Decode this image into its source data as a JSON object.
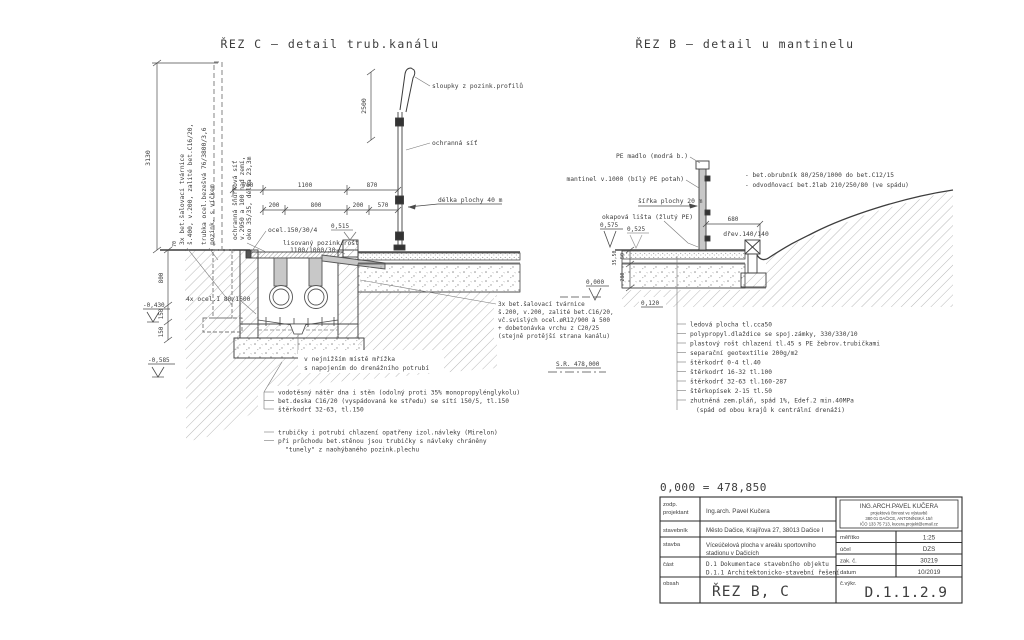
{
  "c": {
    "title": "ŘEZ C  –  detail trub.kanálu",
    "rot1a": "3x bet.šalovací tvárnice",
    "rot1b": "š.400, v.200, zalité bet.C16/20,",
    "rot2a": "trubka ocel.bezešvá 76/3800/3,6",
    "rot2b": "pozink. s víčkem",
    "rot3a": "ochranná šňůrková síť",
    "rot3b": "v.2950 a 100 nad zemí,",
    "rot3c": "oko 35/35, délka 23,3m",
    "sloupky": "sloupky z pozink.profilů",
    "ochranna_sit": "ochranná síť",
    "delka": "délka plochy 40 m",
    "ocel150": "ocel.150/30/4",
    "rost1": "lisovaný pozink.rošt",
    "rost2": "1100/1000/30",
    "elev515": "0,515",
    "ocel4x": "4x ocel.I 80/1600",
    "tv1": "3x bet.šalovací tvárnice",
    "tv2": "š.200, v.200, zalité bet.C16/20,",
    "tv3": "vč.svislých ocel.øR12/900 à 500",
    "tv4": "+ dobetonávka vrchu z C20/25",
    "tv5": "(stejně protější strana kanálu)",
    "mrizka1": "v nejnižším místě mřížka",
    "mrizka2": "s napojením do drenážního potrubí",
    "elev430": "-0,430",
    "elev585": "-0,585",
    "dim3130": "3130",
    "dim2500": "2500",
    "dim700": "700",
    "dim1100": "1100",
    "dim870": "870",
    "dim200a": "200",
    "dim800h": "800",
    "dim200b": "200",
    "dim570": "570",
    "dim70": "70",
    "dim800v": "800",
    "dim150a": "150",
    "dim150b": "150",
    "notes1": [
      "vodotěsný nátěr dna i stěn (odolný proti 35% monopropylénglykolu)",
      "bet.deska C16/20 (vyspádovaná ke středu) se sítí 150/5, tl.150",
      "štěrkodrť 32-63, tl.150"
    ],
    "notes2": [
      "trubičky i potrubí chlazení opatřeny izol.návleky (Mirelon)",
      "při průchodu bet.stěnou jsou trubičky s návleky chráněny",
      "\"tunely\" z naohýbaného pozink.plechu"
    ]
  },
  "b": {
    "title": "ŘEZ B  –  detail u mantinelu",
    "pe_madlo": "PE madlo (modrá b.)",
    "mantinel": "mantinel v.1000 (bílý PE potah)",
    "obrubnik": "-  bet.obrubník 80/250/1000 do bet.C12/15",
    "zlab": "-  odvodňovací bet.žlab 210/250/80 (ve spádu)",
    "sirka": "šířka plochy 20 m",
    "okapova": "okapová lišta (žlutý PE)",
    "elev575": "0,575",
    "elev525": "0,525",
    "dim680": "680",
    "drev": "dřev.140/140",
    "elev000": "0,000",
    "elev120": "0,120",
    "dim50": "50",
    "dim3550": "35,50",
    "dim280": "280",
    "sr": "S.R.  478,000",
    "layers": [
      "ledová plocha tl.cca50",
      "polypropyl.dlaždice se spoj.zámky, 330/330/10",
      "plastový rošt chlazení tl.45 s PE žebrov.trubičkami",
      "separační geotextílie 200g/m2",
      "štěrkodrť 0-4 tl.40",
      "štěrkodrť 16-32 tl.100",
      "štěrkodrť 32-63 tl.160-287",
      "štěrkopísek 2-15 tl.50",
      "zhutněná zem.pláň, spád 1%, Edef.2 min.40MPa",
      "(spád od obou krajů k centrální drenáži)"
    ]
  },
  "tb": {
    "datum_eq": "0,000  =  478,850",
    "zodp_l1": "zodp.",
    "zodp_l2": "projektant",
    "zodp_v": "Ing.arch. Pavel Kučera",
    "stavebnik_l": "stavebník",
    "stavebnik_v": "Město Dačice, Krajířova 27, 38013 Dačice I",
    "stavba_l": "stavba",
    "stavba_v1": "Víceúčelová plocha v areálu sportovního",
    "stavba_v2": "stadionu v Dačicích",
    "cast_l": "část",
    "cast_v1": "D.1    Dokumentace stavebního objektu",
    "cast_v2": "D.1.1  Architektonicko-stavební řešení",
    "obsah_l": "obsah",
    "obsah_v": "ŘEZ B, C",
    "firm1": "ING.ARCH.PAVEL KUČERA",
    "firm2": "projektová činnost ve výstavbě",
    "firm3": "380 01 DAČICE, ANTONÍNSKÁ 15/I",
    "firm4": "IČO 133 75 713, kucera.projekt@email.cz",
    "meritko_l": "měřítko",
    "meritko_v": "1:25",
    "ucel_l": "účel",
    "ucel_v": "DZS",
    "zak_l": "zak. č.",
    "zak_v": "30219",
    "datum_l": "datum",
    "datum_v": "10/2019",
    "cvykr_l": "č.výkr.",
    "cvykr_v": "D.1.1.2.9"
  }
}
